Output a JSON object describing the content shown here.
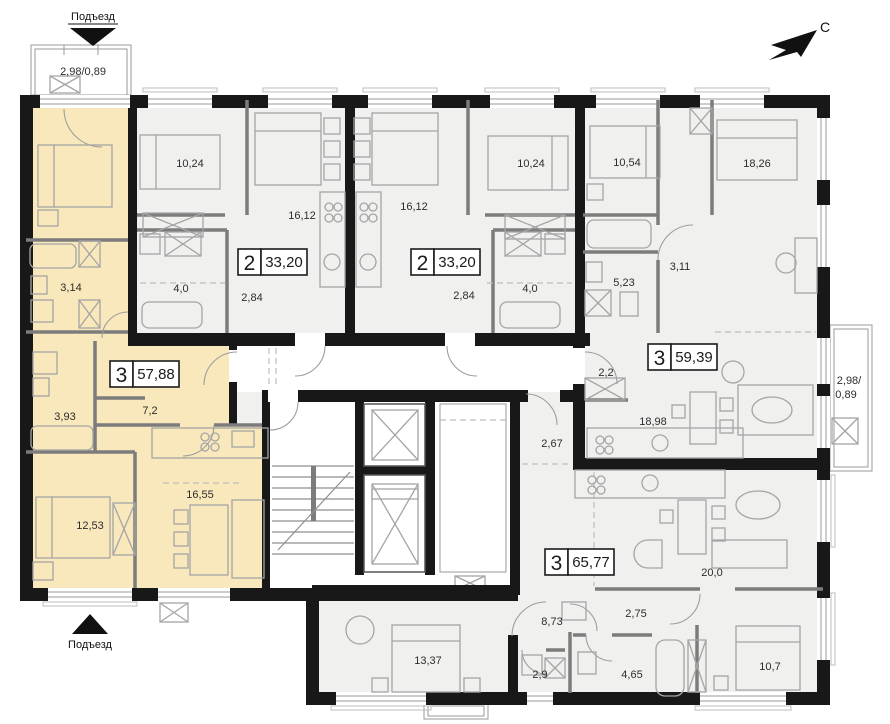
{
  "colors": {
    "highlight_apartment": "#f8e8bb",
    "apartment_fill": "#f0f0ef",
    "wall": "#181818"
  },
  "compass": {
    "north_label": "С"
  },
  "entrances": {
    "top": "Подъезд",
    "bottom": "Подъезд"
  },
  "balconies": {
    "top_left": "2,98/0,89",
    "right_line1": "2,98/",
    "right_line2": "0,89"
  },
  "badges": [
    {
      "id": "apt-2a",
      "rooms": "2",
      "area": "33,20"
    },
    {
      "id": "apt-2b",
      "rooms": "2",
      "area": "33,20"
    },
    {
      "id": "apt-3a-highlight",
      "rooms": "3",
      "area": "57,88"
    },
    {
      "id": "apt-3b",
      "rooms": "3",
      "area": "59,39"
    },
    {
      "id": "apt-3c",
      "rooms": "3",
      "area": "65,77"
    }
  ],
  "room_areas": {
    "apt3a_bath1": "3,14",
    "apt3a_bath2": "3,93",
    "apt3a_hall": "7,2",
    "apt3a_bedroom": "12,53",
    "apt3a_living": "16,55",
    "apt2a_bedroom": "10,24",
    "apt2a_living": "16,12",
    "apt2a_hall": "4,0",
    "apt2a_entry": "2,84",
    "apt2b_bedroom": "10,24",
    "apt2b_living": "16,12",
    "apt2b_hall": "4,0",
    "apt2b_entry": "2,84",
    "apt3b_bedroom1": "10,54",
    "apt3b_bedroom2": "18,26",
    "apt3b_hall": "3,11",
    "apt3b_bath": "5,23",
    "apt3b_entry": "2,2",
    "apt3b_living": "18,98",
    "apt3c_entry": "2,67",
    "apt3c_living": "20,0",
    "apt3c_hall2": "2,75",
    "apt3c_hall": "8,73",
    "apt3c_bedroom1": "13,37",
    "apt3c_bath1": "2,9",
    "apt3c_bath2": "4,65",
    "apt3c_bedroom2": "10,7"
  }
}
